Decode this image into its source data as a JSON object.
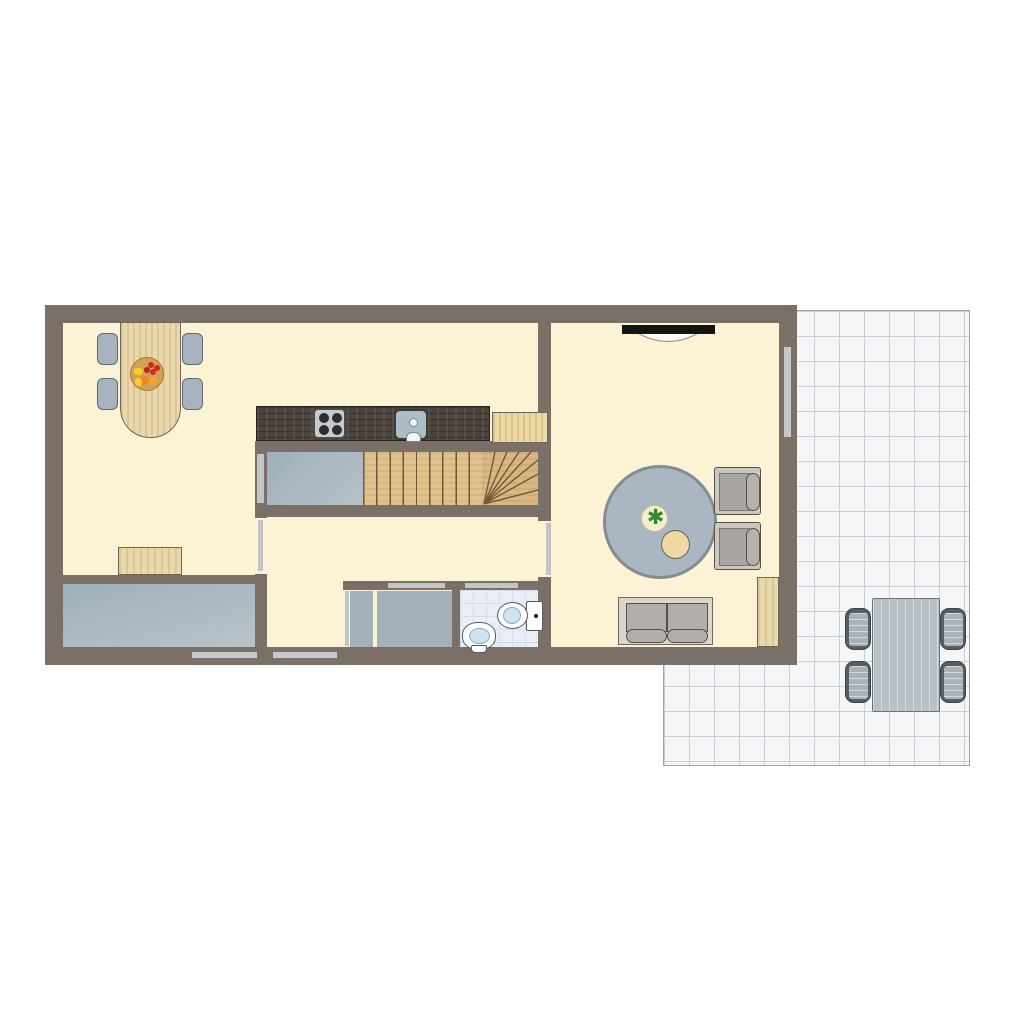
{
  "meta": {
    "type": "floor-plan",
    "view": "top-down",
    "text_visible": false
  },
  "colors": {
    "wall": "#7A7067",
    "floor": "#FCF2D6",
    "tileBg": "#F5F6F8",
    "tileLine": "#CBD0D6",
    "bathTile": "#E9EEF6",
    "bathTileLine": "#D6DEEC",
    "greyFill": "#A3B0BA",
    "greyChair": "#A7B3BE",
    "wood": "#EAD8AB",
    "cabinetWood": "#ECD9A4",
    "stairWood": "#E0C28C",
    "winderWood": "#D9B780",
    "counter": "#4B443D",
    "burner": "#2E2E2E",
    "rug": "#AAB7C2",
    "tv": "#141414",
    "sofaFrame": "#D8D7CB",
    "cushion": "#B2AEAA",
    "chairFrame": "#CBC8C2",
    "patioFurniture": "#B7C0C5",
    "patioChairDark": "#565D63",
    "doorLeaf": "#C2C5C8",
    "windowBar": "#C6C8CA",
    "fixtureBlue": "#CFE2F0",
    "fruitBowl": "#CFA257",
    "cherry": "#D6261F",
    "orangeFruit": "#F08617",
    "yellowFruit": "#F7D028",
    "plantGreen": "#2F8A2C",
    "potCream": "#F7EDD2"
  },
  "rooms": [
    {
      "id": "dining-kitchen",
      "name": "dining-and-kitchen"
    },
    {
      "id": "living-room",
      "name": "living-room"
    },
    {
      "id": "hallway",
      "name": "hallway"
    },
    {
      "id": "staircase",
      "name": "winder-staircase"
    },
    {
      "id": "bathroom",
      "name": "bathroom"
    },
    {
      "id": "storage",
      "name": "storage-closet"
    },
    {
      "id": "utility",
      "name": "utility-room"
    },
    {
      "id": "patio",
      "name": "tiled-patio"
    }
  ],
  "furniture": {
    "dining": [
      "dining-table",
      "dining-chair x4",
      "fruit-bowl",
      "sideboard"
    ],
    "kitchen": [
      "counter",
      "stove-4-burners",
      "sink",
      "cabinet"
    ],
    "living": [
      "wall-tv",
      "round-rug",
      "plant",
      "side-table",
      "armchair x2",
      "sofa-2-seat",
      "sideboard"
    ],
    "bathroom": [
      "toilet",
      "washbasin"
    ],
    "patio": [
      "outdoor-table",
      "outdoor-chair x4"
    ]
  },
  "glyphs": {
    "plant": "✱"
  }
}
